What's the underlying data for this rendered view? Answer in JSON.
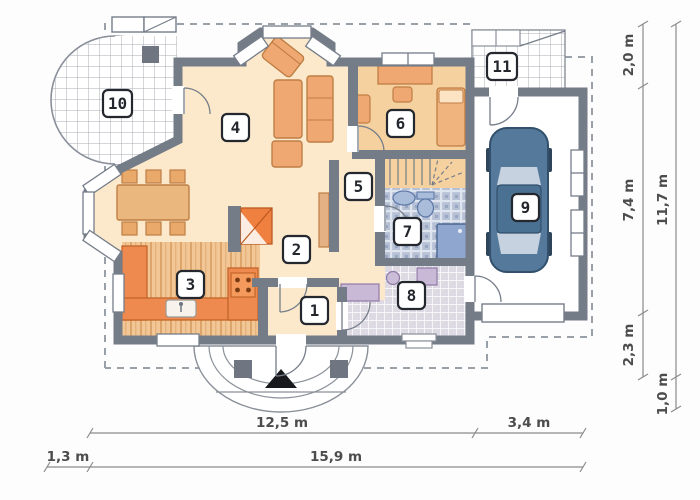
{
  "rooms": [
    "1",
    "2",
    "3",
    "4",
    "5",
    "6",
    "7",
    "8",
    "9",
    "10",
    "11"
  ],
  "dimensions": {
    "right_segments": [
      "2,0 m",
      "7,4 m",
      "2,3 m"
    ],
    "right_total": "11,7 m",
    "right_bottom": "1,0 m",
    "bottom_main": "12,5 m",
    "bottom_garage": "3,4 m",
    "bottom_left": "1,3 m",
    "bottom_total": "15,9 m"
  },
  "colors": {
    "wall": "#747c88",
    "floor_main": "#fce9cb",
    "floor_bedroom": "#f6d1a0",
    "kitchen_counter": "#ee8a4f",
    "furniture": "#efa871",
    "fireplace": "#f08040",
    "bath_tile": "#b7c1d6",
    "utility_tile": "#dedae4",
    "appliance": "#c9b8d6",
    "car_body": "#54799b",
    "shower": "#8fa6cf"
  }
}
